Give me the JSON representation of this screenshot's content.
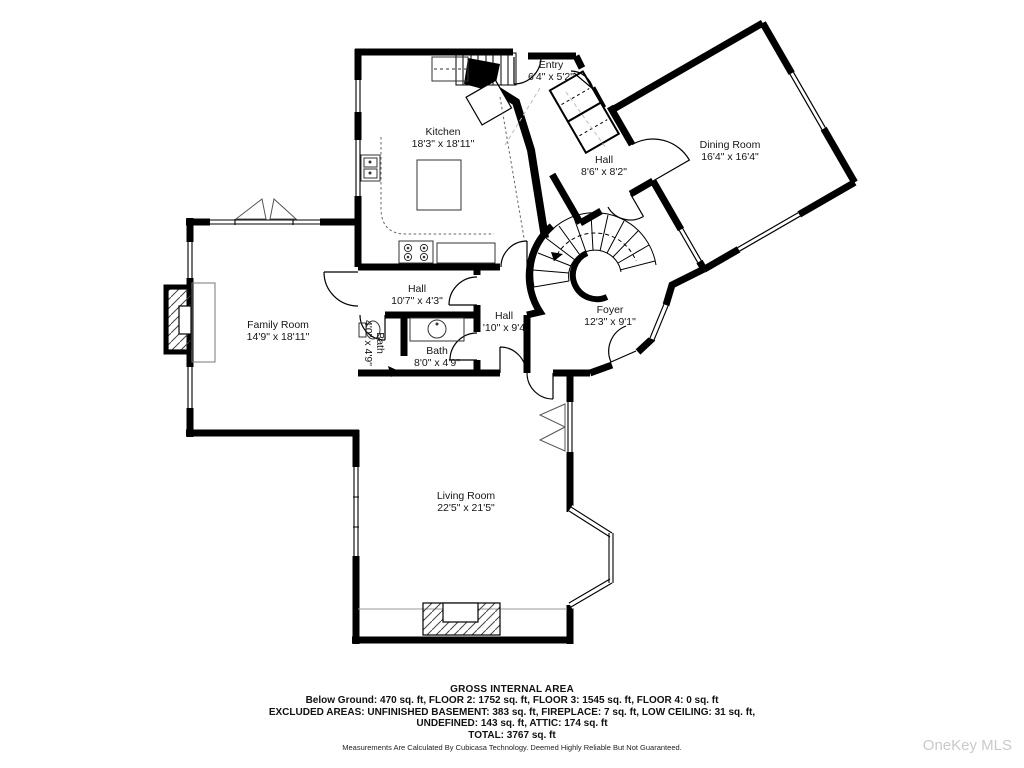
{
  "plan": {
    "rooms": [
      {
        "name": "Entry",
        "dims": "6'4\" x 5'2\""
      },
      {
        "name": "Kitchen",
        "dims": "18'3\" x 18'11\""
      },
      {
        "name": "Hall",
        "dims": "8'6\" x 8'2\""
      },
      {
        "name": "Dining Room",
        "dims": "16'4\" x 16'4\""
      },
      {
        "name": "Family Room",
        "dims": "14'9\" x 18'11\""
      },
      {
        "name": "Hall",
        "dims": "10'7\" x 4'3\""
      },
      {
        "name": "Bath",
        "dims": "4'0\" x 4'9\""
      },
      {
        "name": "Bath",
        "dims": "8'0\" x 4'9\""
      },
      {
        "name": "Hall",
        "dims": "'10\" x 9'4"
      },
      {
        "name": "Foyer",
        "dims": "12'3\" x 9'1\""
      },
      {
        "name": "Living Room",
        "dims": "22'5\" x 21'5\""
      }
    ],
    "footer": {
      "title": "GROSS INTERNAL AREA",
      "line1": "Below Ground: 470 sq. ft, FLOOR 2: 1752 sq. ft, FLOOR 3: 1545 sq. ft, FLOOR 4: 0 sq. ft",
      "line2": "EXCLUDED AREAS: UNFINISHED BASEMENT: 383 sq. ft, FIREPLACE: 7 sq. ft, LOW CEILING: 31 sq. ft,",
      "line3": "UNDEFINED: 143 sq. ft, ATTIC: 174 sq. ft",
      "line4": "TOTAL: 3767 sq. ft",
      "disclaimer": "Measurements Are Calculated By Cubicasa Technology. Deemed Highly Reliable But Not Guaranteed."
    },
    "watermark": "OneKey MLS",
    "colors": {
      "wall": "#000000",
      "background": "#ffffff",
      "watermark": "#c9c9c9"
    }
  }
}
